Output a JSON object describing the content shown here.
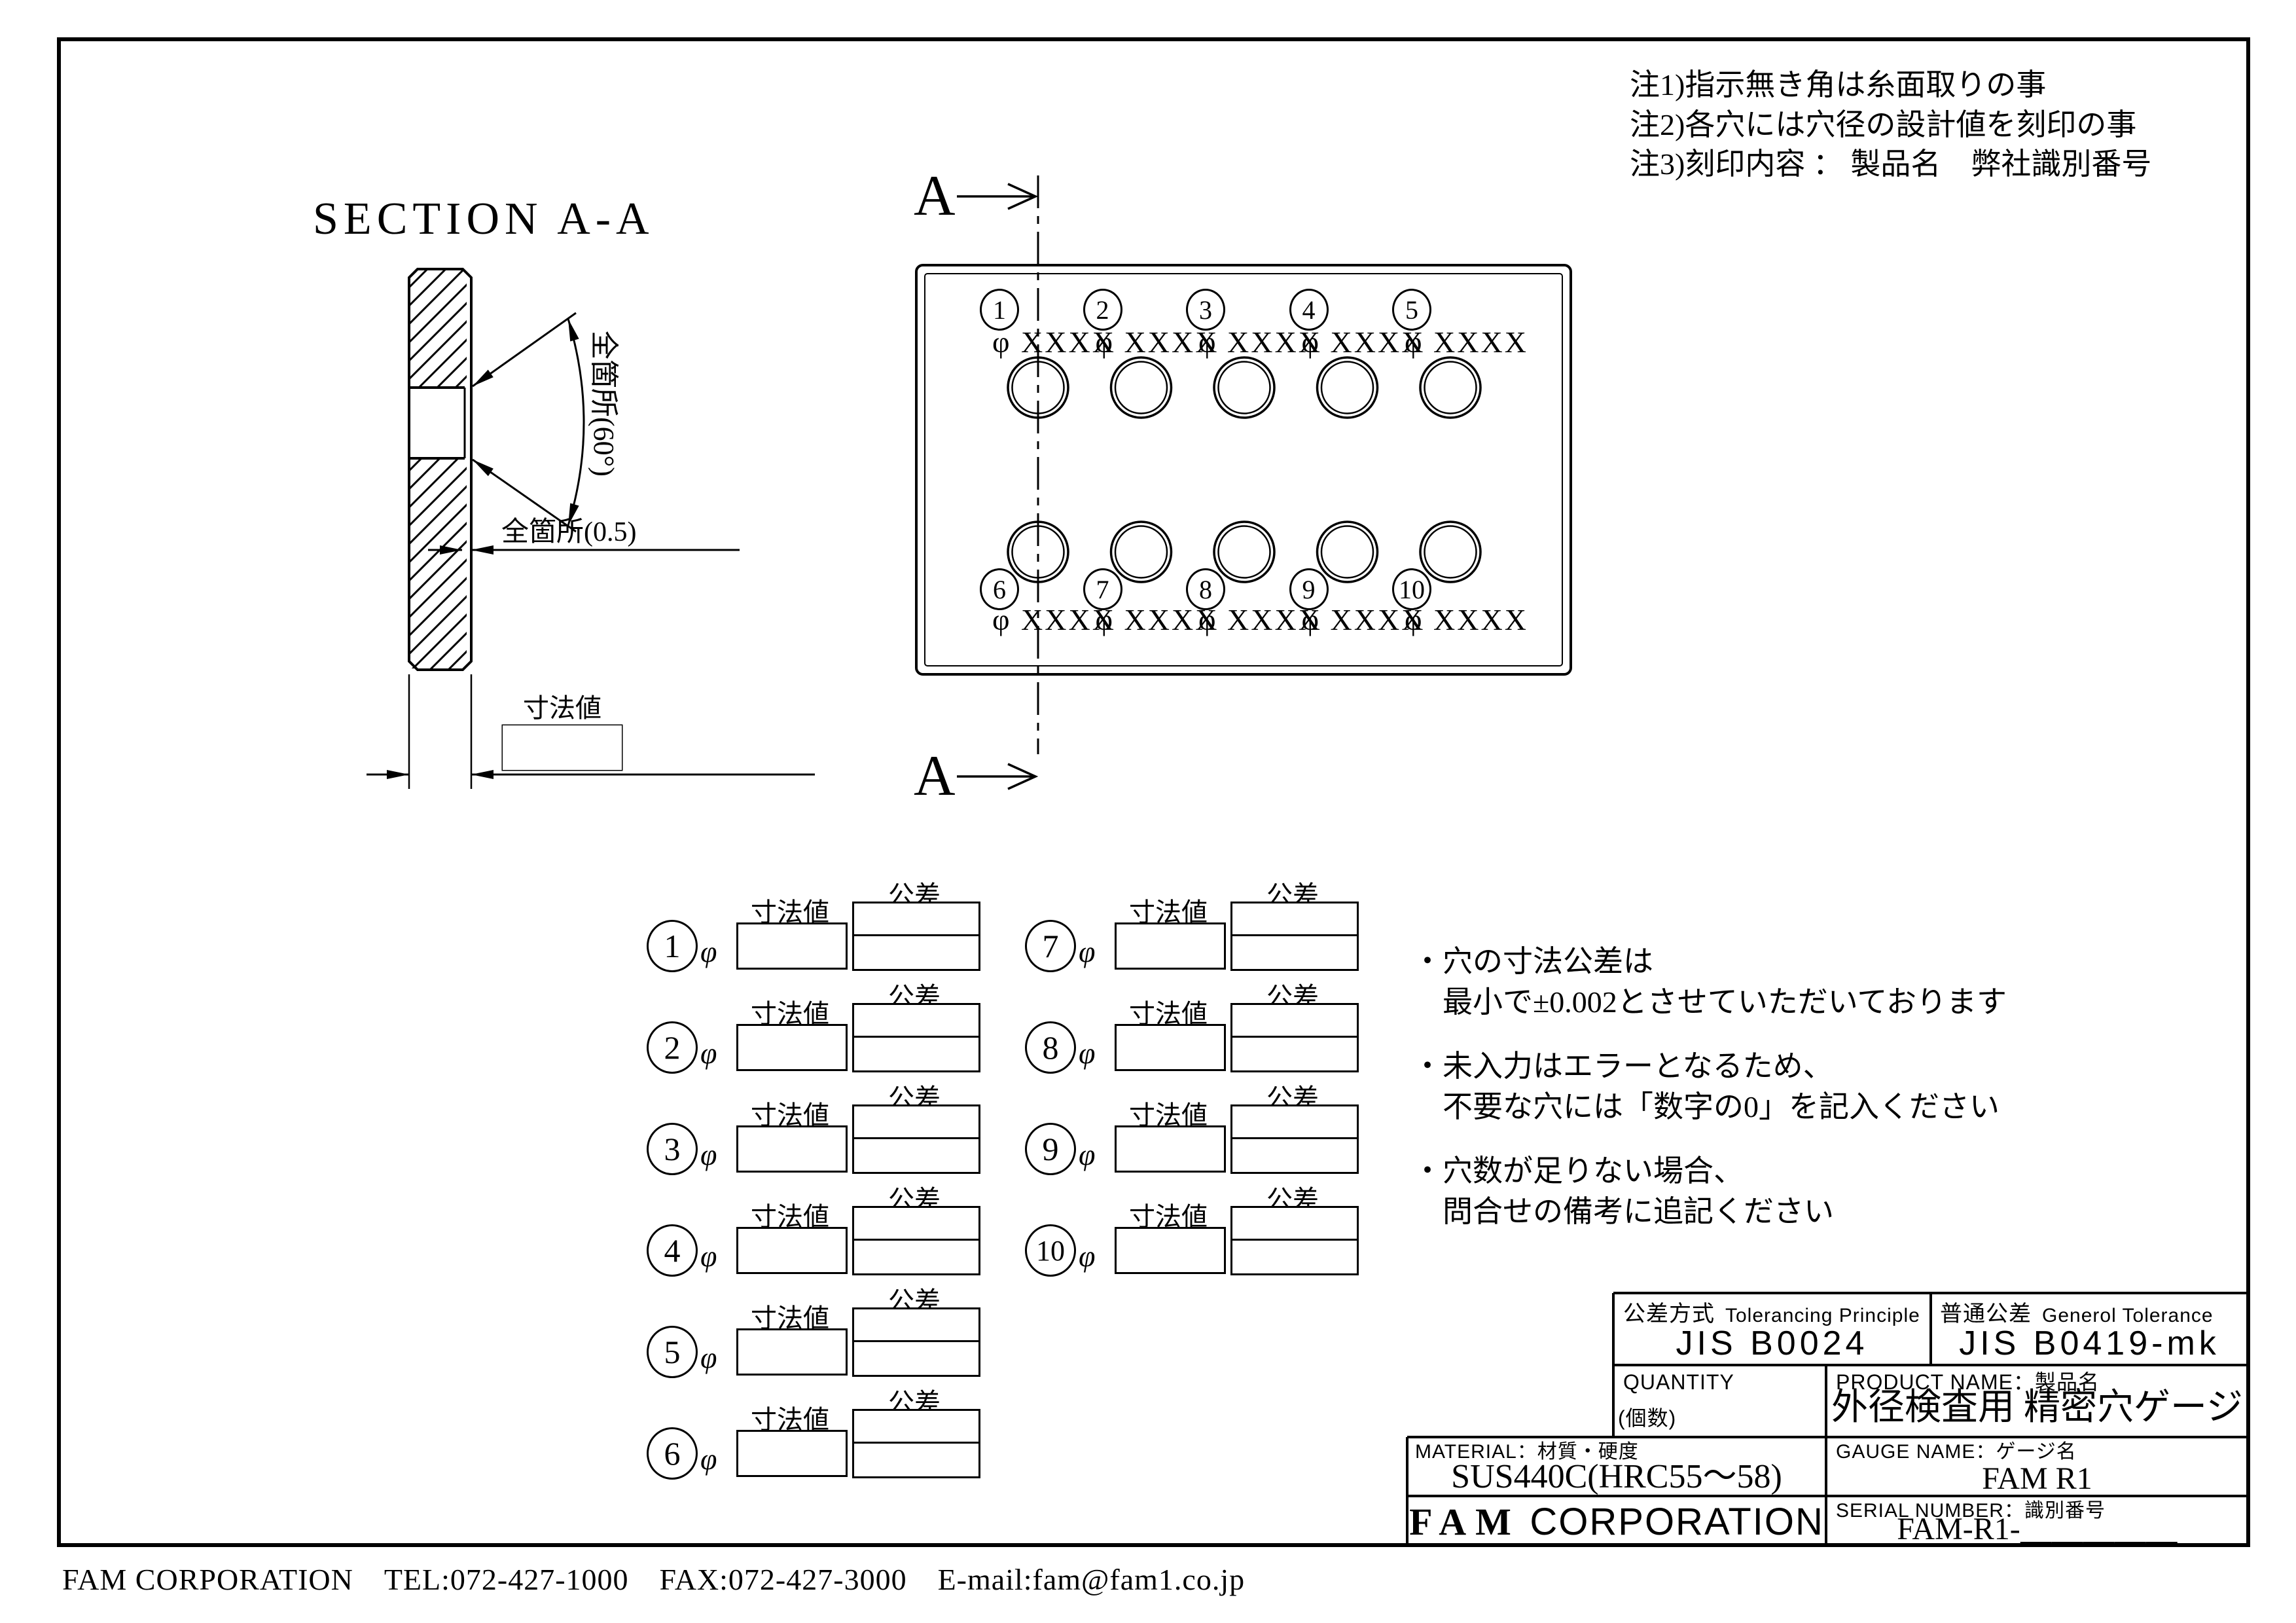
{
  "drawing": {
    "notes": [
      "注1)指示無き角は糸面取りの事",
      "注2)各穴には穴径の設計値を刻印の事",
      "注3)刻印内容 ： 製品名　弊社識別番号"
    ],
    "section_view": {
      "title": "SECTION A-A",
      "chamfer_angle_label": "全箇所(60°)",
      "chamfer_depth_label": "全箇所(0.5)",
      "thickness_label": "寸法値"
    },
    "plate_view": {
      "section_marker": "A",
      "hole_numbers": [
        "1",
        "2",
        "3",
        "4",
        "5",
        "6",
        "7",
        "8",
        "9",
        "10"
      ],
      "hole_diameter_placeholder": "φ XXXX"
    },
    "spec_form": {
      "phi_symbol": "φ",
      "dimension_label": "寸法値",
      "tolerance_label": "公差",
      "row_numbers": [
        "1",
        "2",
        "3",
        "4",
        "5",
        "6",
        "7",
        "8",
        "9",
        "10"
      ]
    },
    "side_notes": [
      [
        "・穴の寸法公差は",
        "最小で±0.002とさせていただいております"
      ],
      [
        "・未入力はエラーとなるため、",
        "不要な穴には「数字の0」を記入ください"
      ],
      [
        "・穴数が足りない場合、",
        "問合せの備考に追記ください"
      ]
    ],
    "title_block": {
      "tolerancing_label_jp": "公差方式",
      "tolerancing_label_en": "Tolerancing Principle",
      "tolerancing_value": "JIS B0024",
      "general_tolerance_label_jp": "普通公差",
      "general_tolerance_label_en": "Generol Tolerance",
      "general_tolerance_value": "JIS B0419-mk",
      "quantity_label": "QUANTITY",
      "quantity_sub_label": "(個数)",
      "product_name_label": "PRODUCT NAME：製品名",
      "product_name_value": "外径検査用 精密穴ゲージ",
      "material_label": "MATERIAL：材質・硬度",
      "material_value": "SUS440C(HRC55～58)",
      "gauge_name_label": "GAUGE NAME：ゲージ名",
      "gauge_name_value": "FAM R1",
      "company_name_bold": "FAM",
      "company_name_rest": "CORPORATION",
      "serial_number_label": "SERIAL NUMBER：識別番号",
      "serial_number_value": "FAM-R1-＿＿＿＿＿"
    },
    "footer": "FAM CORPORATION　TEL:072-427-1000　FAX:072-427-3000　E-mail:fam@fam1.co.jp"
  }
}
